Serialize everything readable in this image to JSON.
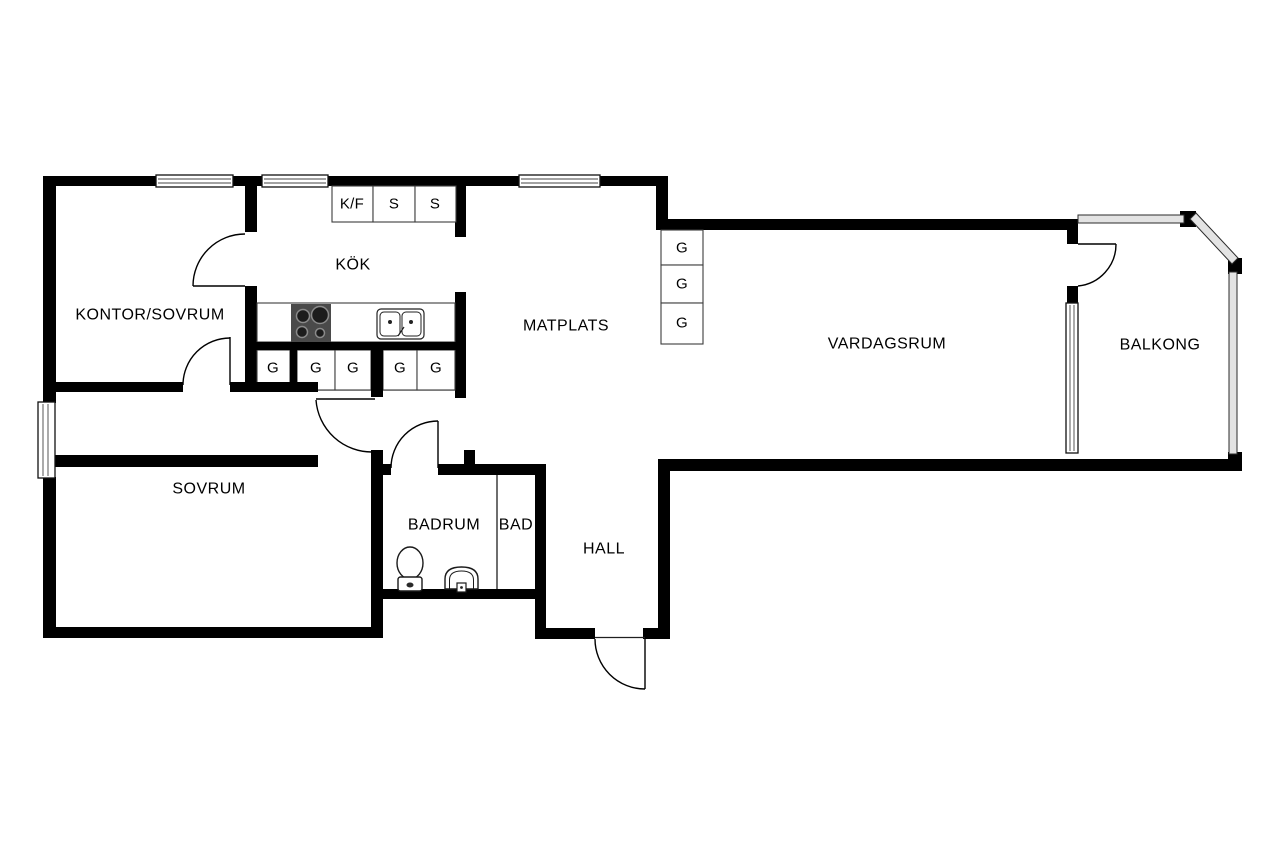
{
  "rooms": {
    "kontor_sovrum": "KONTOR/SOVRUM",
    "kok": "KÖK",
    "matplats": "MATPLATS",
    "vardagsrum": "VARDAGSRUM",
    "balkong": "BALKONG",
    "sovrum": "SOVRUM",
    "badrum": "BADRUM",
    "bad": "BAD",
    "hall": "HALL"
  },
  "cabinets": {
    "fridge_freezer": "K/F",
    "closet_1": "S",
    "closet_2": "S",
    "wardrobes_row": [
      "G",
      "G",
      "G",
      "G",
      "G"
    ],
    "wardrobes_column": [
      "G",
      "G",
      "G"
    ]
  },
  "colors": {
    "wall": "#000000",
    "background": "#ffffff",
    "railing": "#e3e3e3",
    "stove": "#4a4a4a"
  }
}
